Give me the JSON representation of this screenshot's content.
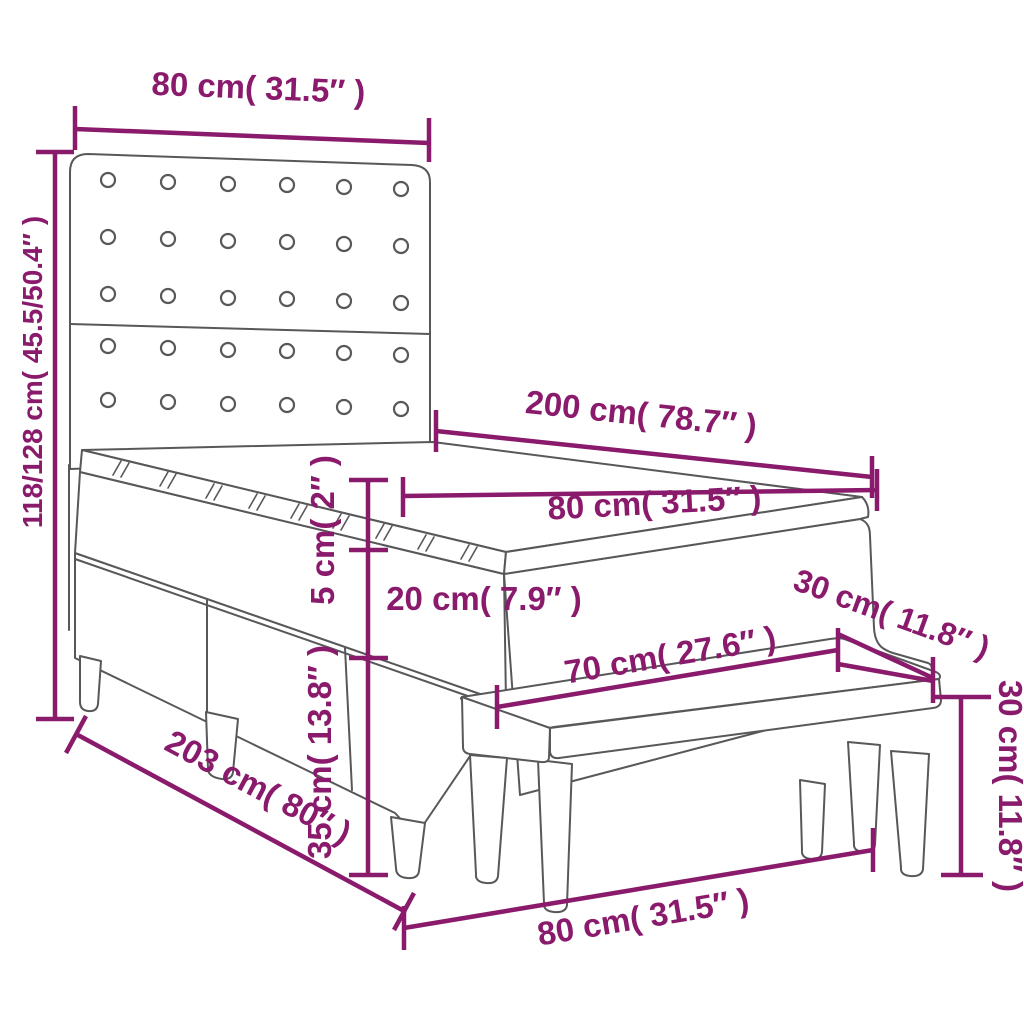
{
  "colors": {
    "dimension": "#8a1a6b",
    "outline": "#58585a",
    "background": "#ffffff"
  },
  "measurements": {
    "headboard_width": {
      "label": "80 cm( 31.5″ )"
    },
    "bed_height": {
      "label": "118/128 cm( 45.5/50.4″ )"
    },
    "mattress_length": {
      "label": "200 cm( 78.7″ )"
    },
    "mattress_width": {
      "label": "80 cm( 31.5″ )"
    },
    "topper_thickness": {
      "label": "5 cm( 2″ )"
    },
    "mattress_thickness": {
      "label": "20 cm( 7.9″ )"
    },
    "base_height": {
      "label": "35 cm( 13.8″ )"
    },
    "bed_length": {
      "label": "203 cm( 80″ )"
    },
    "bench_length": {
      "label": "70 cm( 27.6″ )"
    },
    "bench_depth": {
      "label": "30 cm( 11.8″ )"
    },
    "bench_height": {
      "label": "30 cm( 11.8″ )"
    },
    "bench_width_bottom": {
      "label": "80 cm( 31.5″ )"
    }
  }
}
